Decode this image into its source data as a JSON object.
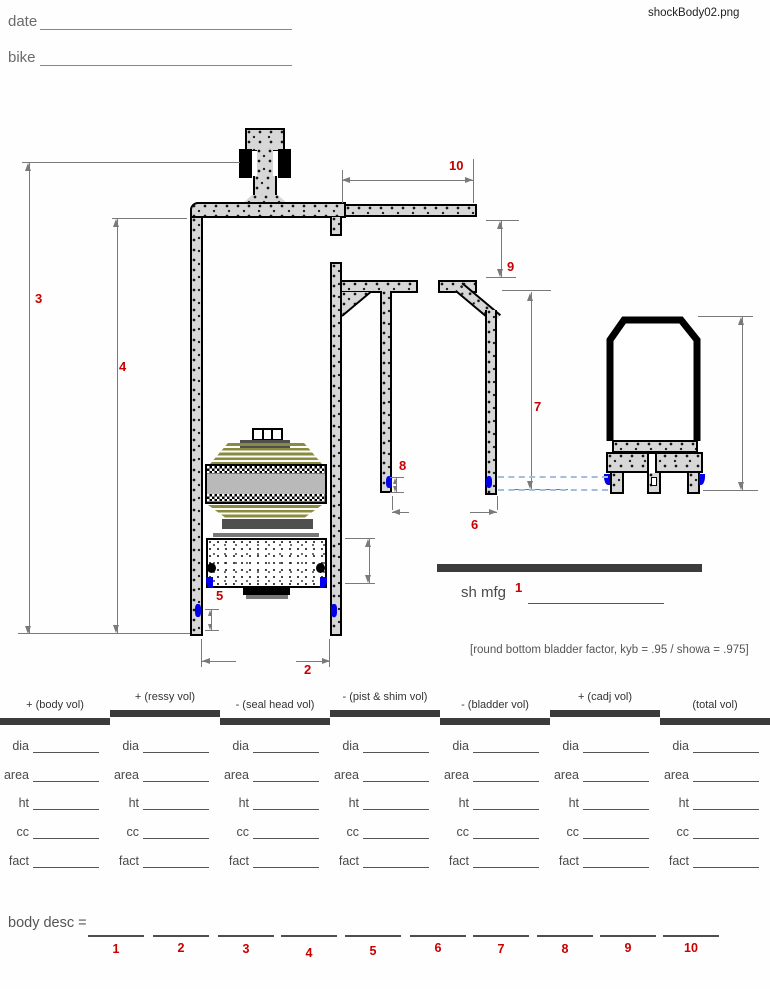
{
  "window": {
    "filename": "shockBody02.png"
  },
  "form_header": {
    "date_label": "date",
    "bike_label": "bike"
  },
  "diagram": {
    "dim_labels": [
      "1",
      "2",
      "3",
      "4",
      "5",
      "6",
      "7",
      "8",
      "9",
      "10"
    ],
    "sh_mfg_label": "sh mfg",
    "note": "[round bottom bladder factor, kyb = .95 / showa = .975]"
  },
  "table": {
    "columns": [
      {
        "header": "+ (body vol)"
      },
      {
        "header": "+ (ressy vol)"
      },
      {
        "header": "- (seal head vol)"
      },
      {
        "header": "- (pist & shim vol)"
      },
      {
        "header": "- (bladder vol)"
      },
      {
        "header": "+ (cadj vol)"
      },
      {
        "header": "(total vol)"
      }
    ],
    "row_labels": [
      "dia",
      "area",
      "ht",
      "cc",
      "fact"
    ]
  },
  "footer": {
    "body_desc_label": "body desc =",
    "slot_numbers": [
      "1",
      "2",
      "3",
      "4",
      "5",
      "6",
      "7",
      "8",
      "9",
      "10"
    ]
  },
  "colors": {
    "accent_red": "#c80000",
    "bar_dark": "#3b3b3b",
    "dim_gray": "#7a7a7a",
    "marker_blue": "#0000ee",
    "shim_olive": "#8b8b3f",
    "dashed_blue": "#a4bedd"
  }
}
